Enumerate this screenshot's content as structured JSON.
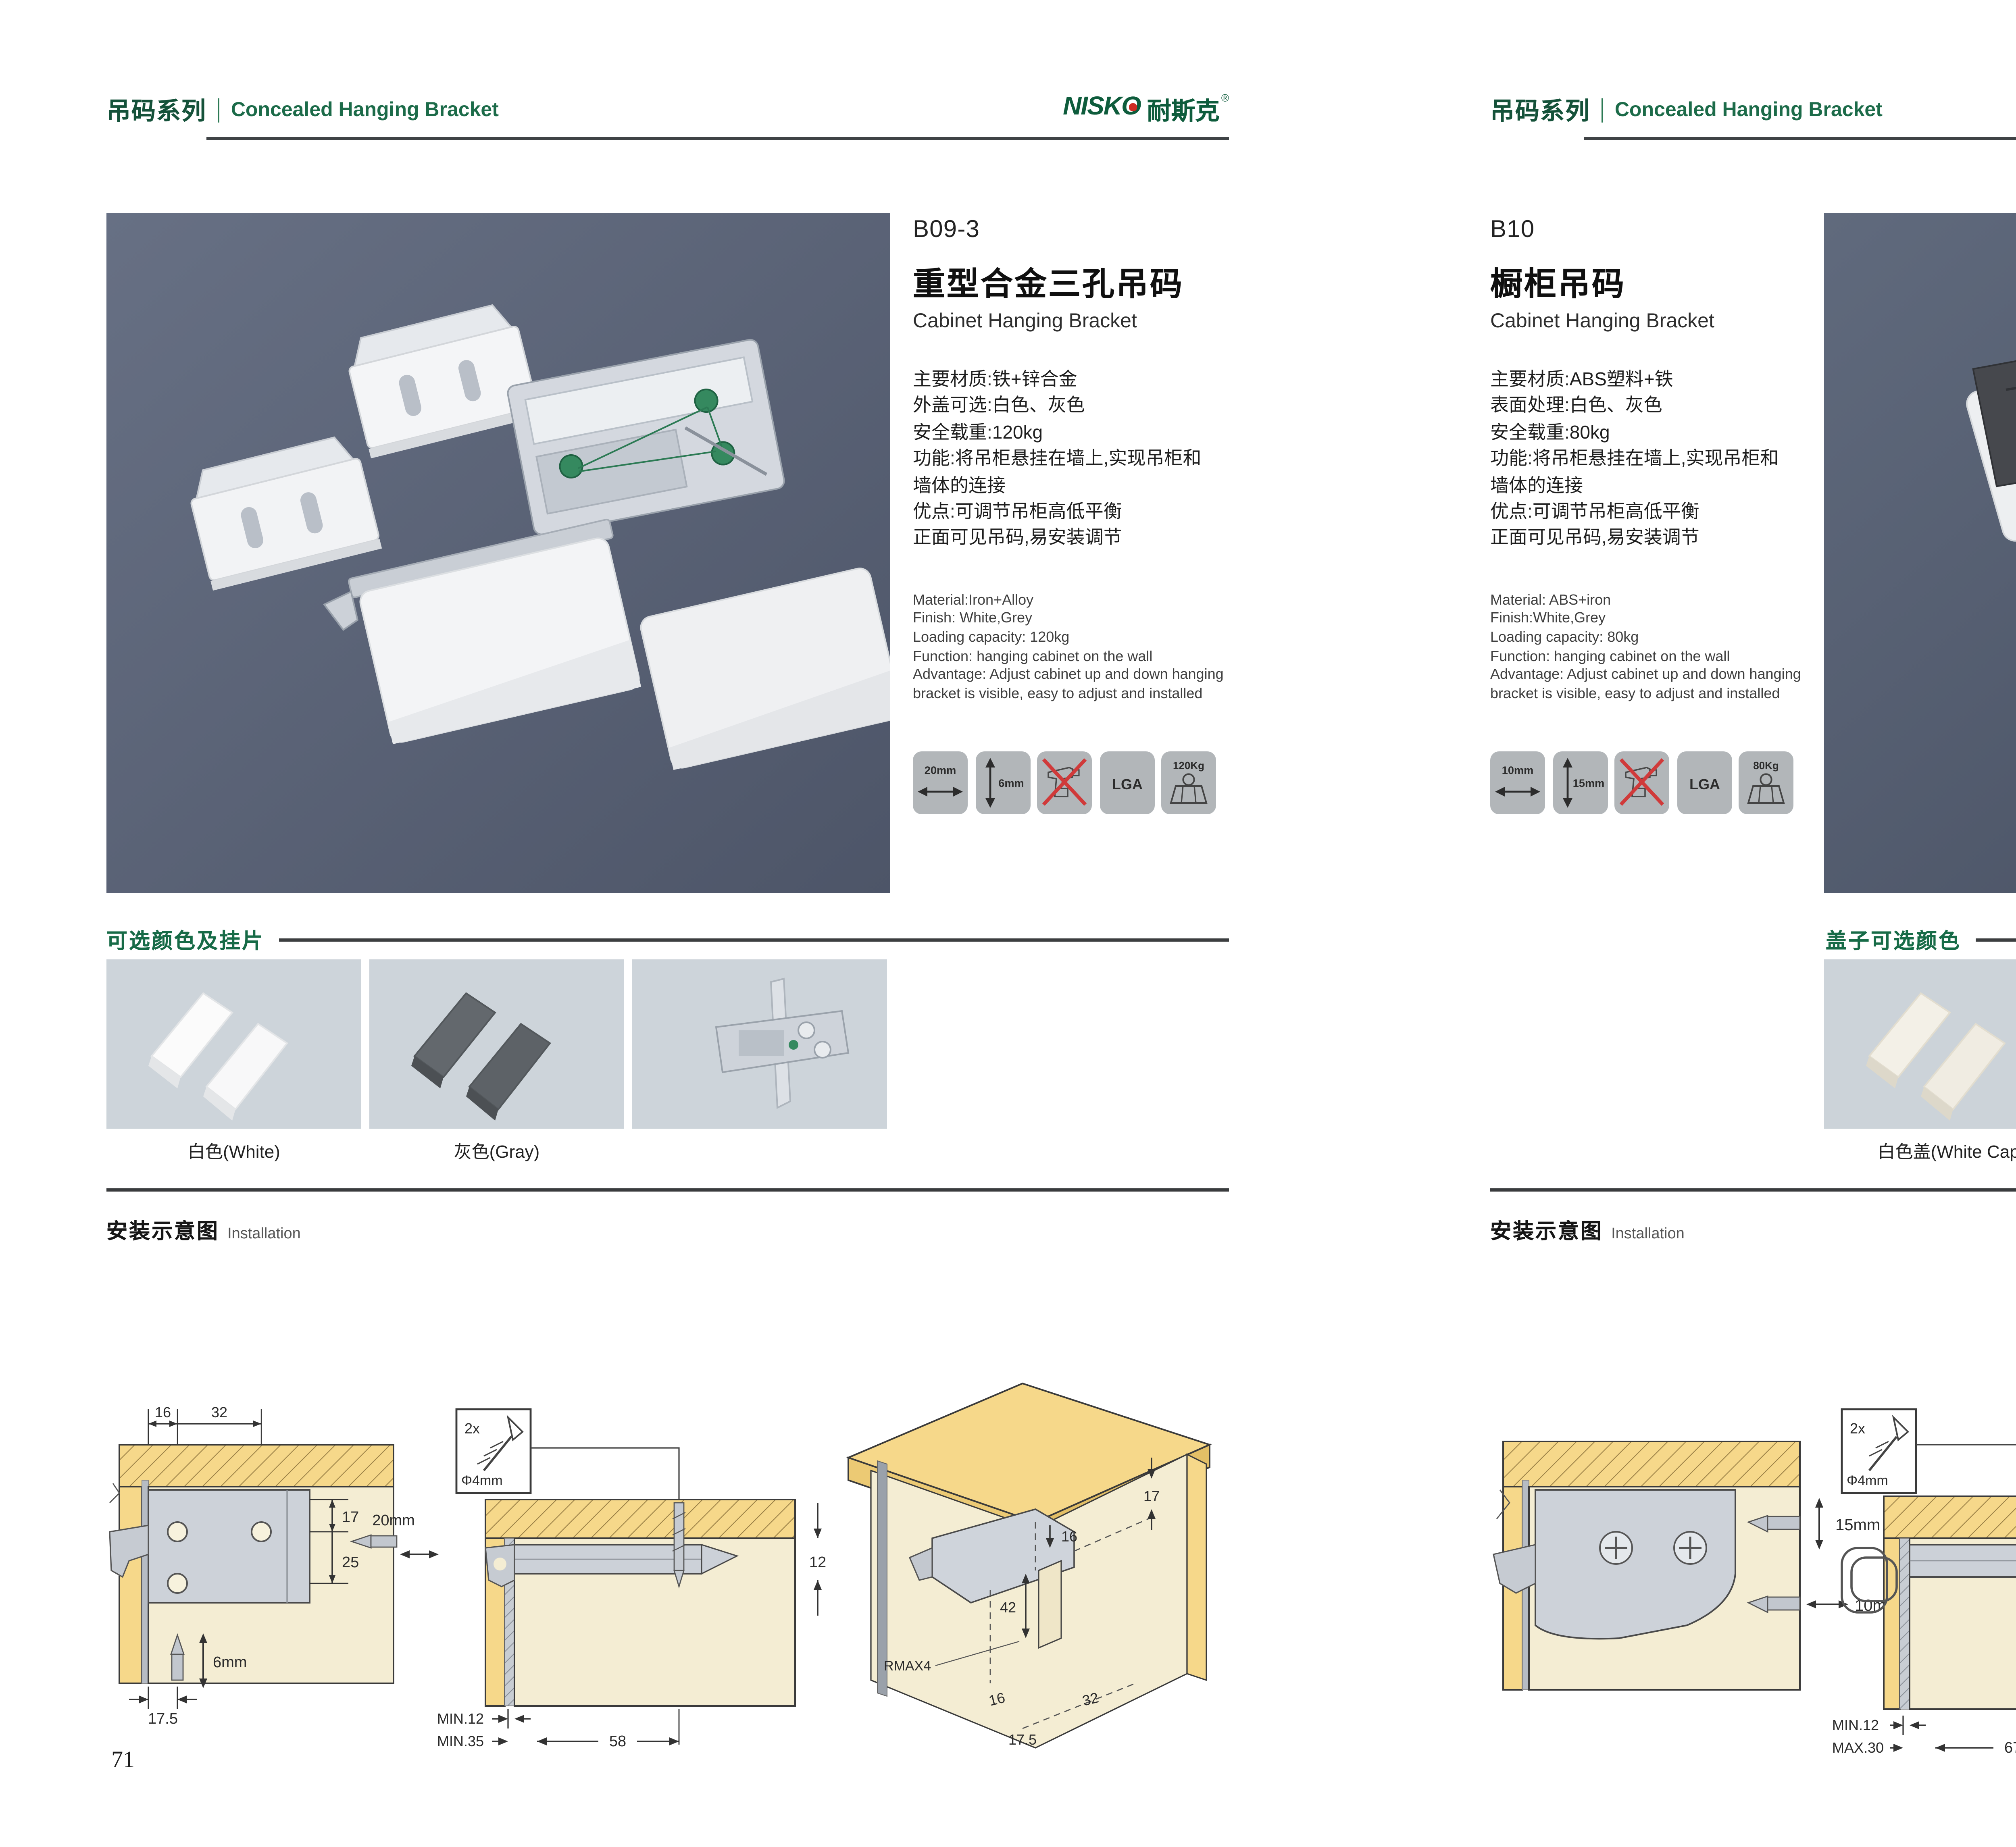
{
  "brand": {
    "latin": "NISKO",
    "cn": "耐斯克",
    "reg": "®"
  },
  "pages": [
    {
      "number": "71",
      "header": {
        "series_cn": "吊码系列",
        "series_en": "Concealed Hanging Bracket"
      },
      "product": {
        "code": "B09-3",
        "name_cn": "重型合金三孔吊码",
        "name_en": "Cabinet Hanging Bracket",
        "specs_cn": [
          "主要材质:铁+锌合金",
          "外盖可选:白色、灰色",
          "安全载重:120kg",
          "功能:将吊柜悬挂在墙上,实现吊柜和",
          "墙体的连接",
          "优点:可调节吊柜高低平衡",
          "正面可见吊码,易安装调节"
        ],
        "specs_en": [
          "Material:Iron+Alloy",
          "Finish: White,Grey",
          "Loading capacity: 120kg",
          "Function: hanging cabinet on the wall",
          "Advantage: Adjust cabinet up and down hanging",
          "bracket is visible, easy to adjust and installed"
        ],
        "icons": {
          "width": "20mm",
          "height": "6mm",
          "cert": "LGA",
          "load": "120Kg"
        }
      },
      "colors": {
        "heading": "可选颜色及挂片",
        "label1": "白色(White)",
        "label2": "灰色(Gray)"
      },
      "install": {
        "heading_cn": "安装示意图",
        "heading_en": "Installation",
        "screw_qty": "2x",
        "screw_dia": "Φ4mm",
        "d1": {
          "dim_top1": "16",
          "dim_top2": "32",
          "dim_r1": "17",
          "dim_r2": "25",
          "bit_h": "20mm",
          "bit_v": "6mm",
          "dim_bottom": "17.5"
        },
        "d2": {
          "dim_depth": "12",
          "dim_min1": "MIN.12",
          "dim_min2": "MIN.35",
          "dim_len": "58"
        },
        "d3": {
          "dim_edge": "17",
          "dim_hole": "16",
          "dim_height": "42",
          "dim_radius": "RMAX4",
          "dim_b1": "16",
          "dim_b2": "32",
          "dim_b3": "17.5"
        }
      }
    },
    {
      "number": "72",
      "header": {
        "series_cn": "吊码系列",
        "series_en": "Concealed Hanging Bracket"
      },
      "product": {
        "code": "B10",
        "name_cn": "橱柜吊码",
        "name_en": "Cabinet Hanging Bracket",
        "specs_cn": [
          "主要材质:ABS塑料+铁",
          "表面处理:白色、灰色",
          "安全载重:80kg",
          "功能:将吊柜悬挂在墙上,实现吊柜和",
          "墙体的连接",
          "优点:可调节吊柜高低平衡",
          "正面可见吊码,易安装调节"
        ],
        "specs_en": [
          "Material: ABS+iron",
          "Finish:White,Grey",
          "Loading capacity: 80kg",
          "Function: hanging cabinet on the wall",
          "Advantage: Adjust cabinet up and down hanging",
          "bracket is visible, easy to adjust and installed"
        ],
        "icons": {
          "width": "10mm",
          "height": "15mm",
          "cert": "LGA",
          "load": "80Kg"
        }
      },
      "colors": {
        "heading": "盖子可选颜色",
        "label1": "白色盖(White Cap)",
        "label2": "灰色盖(Gray Cap)"
      },
      "install": {
        "heading_cn": "安装示意图",
        "heading_en": "Installation",
        "screw_qty": "2x",
        "screw_dia": "Φ4mm",
        "d1": {
          "bit_v": "15mm",
          "bit_h": "10mm"
        },
        "d2": {
          "dim_depth": "18",
          "dim_min1": "MIN.12",
          "dim_min2": "MAX.30",
          "dim_len": "67"
        },
        "d3": {
          "dim_edge": "13",
          "dim_height": "42",
          "dim_radius": "RMAX4",
          "dim_b1": "19",
          "dim_b2": "17",
          "dim_b3": "32"
        }
      }
    }
  ]
}
